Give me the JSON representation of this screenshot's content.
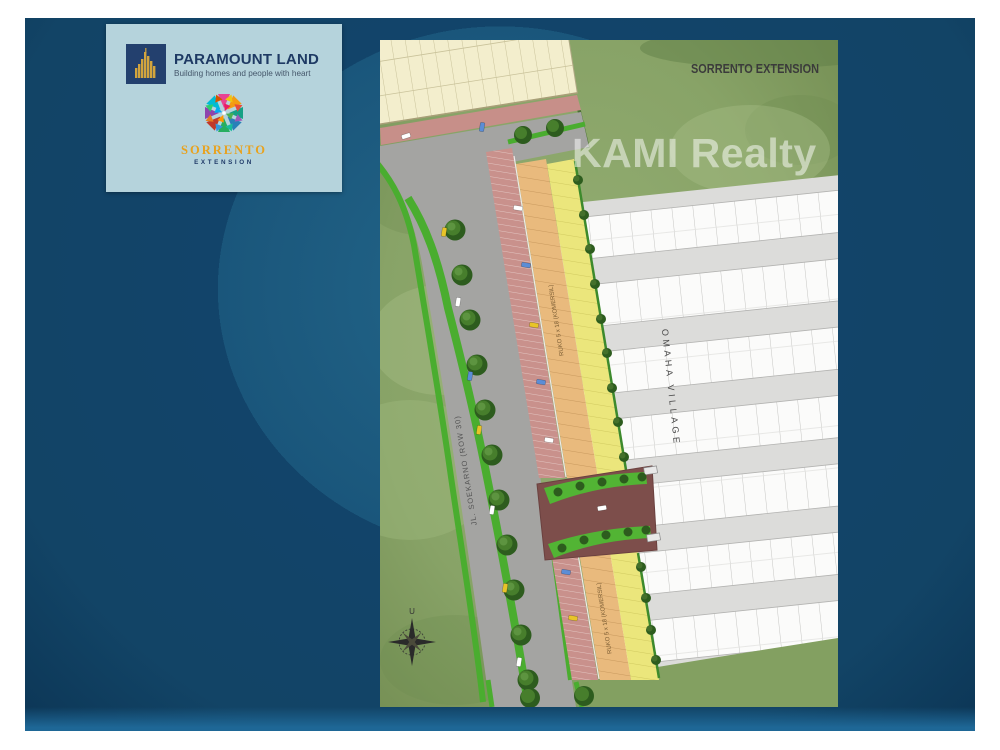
{
  "slide": {
    "background_color": "#12446a",
    "bottom_band_color": "#1e6796"
  },
  "brand_card": {
    "background_color": "#b5d3dc",
    "paramount": {
      "name": "PARAMOUNT LAND",
      "tagline": "Building homes and people with heart",
      "logo_navy": "#23406e",
      "logo_gold": "#d2a43e"
    },
    "sorrento": {
      "name": "SORRENTO",
      "subtitle": "EXTENSION",
      "name_color": "#e8a21e",
      "subtitle_color": "#1f3a68"
    }
  },
  "siteplan": {
    "title": "SORRENTO EXTENSION",
    "watermark": "KAMI Realty",
    "labels": {
      "village": "OMAHA VILLAGE",
      "road": "JL. SOEKARNO (ROW 30)",
      "ruko_upper": "RUKO 5 x 18 (KOMERSIL)",
      "ruko_lower": "RUKO 5 x 18 (KOMERSIL)",
      "compass_north": "U"
    },
    "colors": {
      "grass": "#8ba56b",
      "road": "#a4a4a2",
      "median_green": "#4aad2f",
      "parking_strip": "#c9918c",
      "ruko_strip": "#e9ba7d",
      "house_strip": "#ebe67c",
      "village_block": "#dcdcda",
      "entrance_plaza": "#7d4e4b",
      "commercial_building": "#f3eecd",
      "title_text": "#3b3b3b",
      "watermark_text": "rgba(255,255,255,0.5)"
    }
  }
}
